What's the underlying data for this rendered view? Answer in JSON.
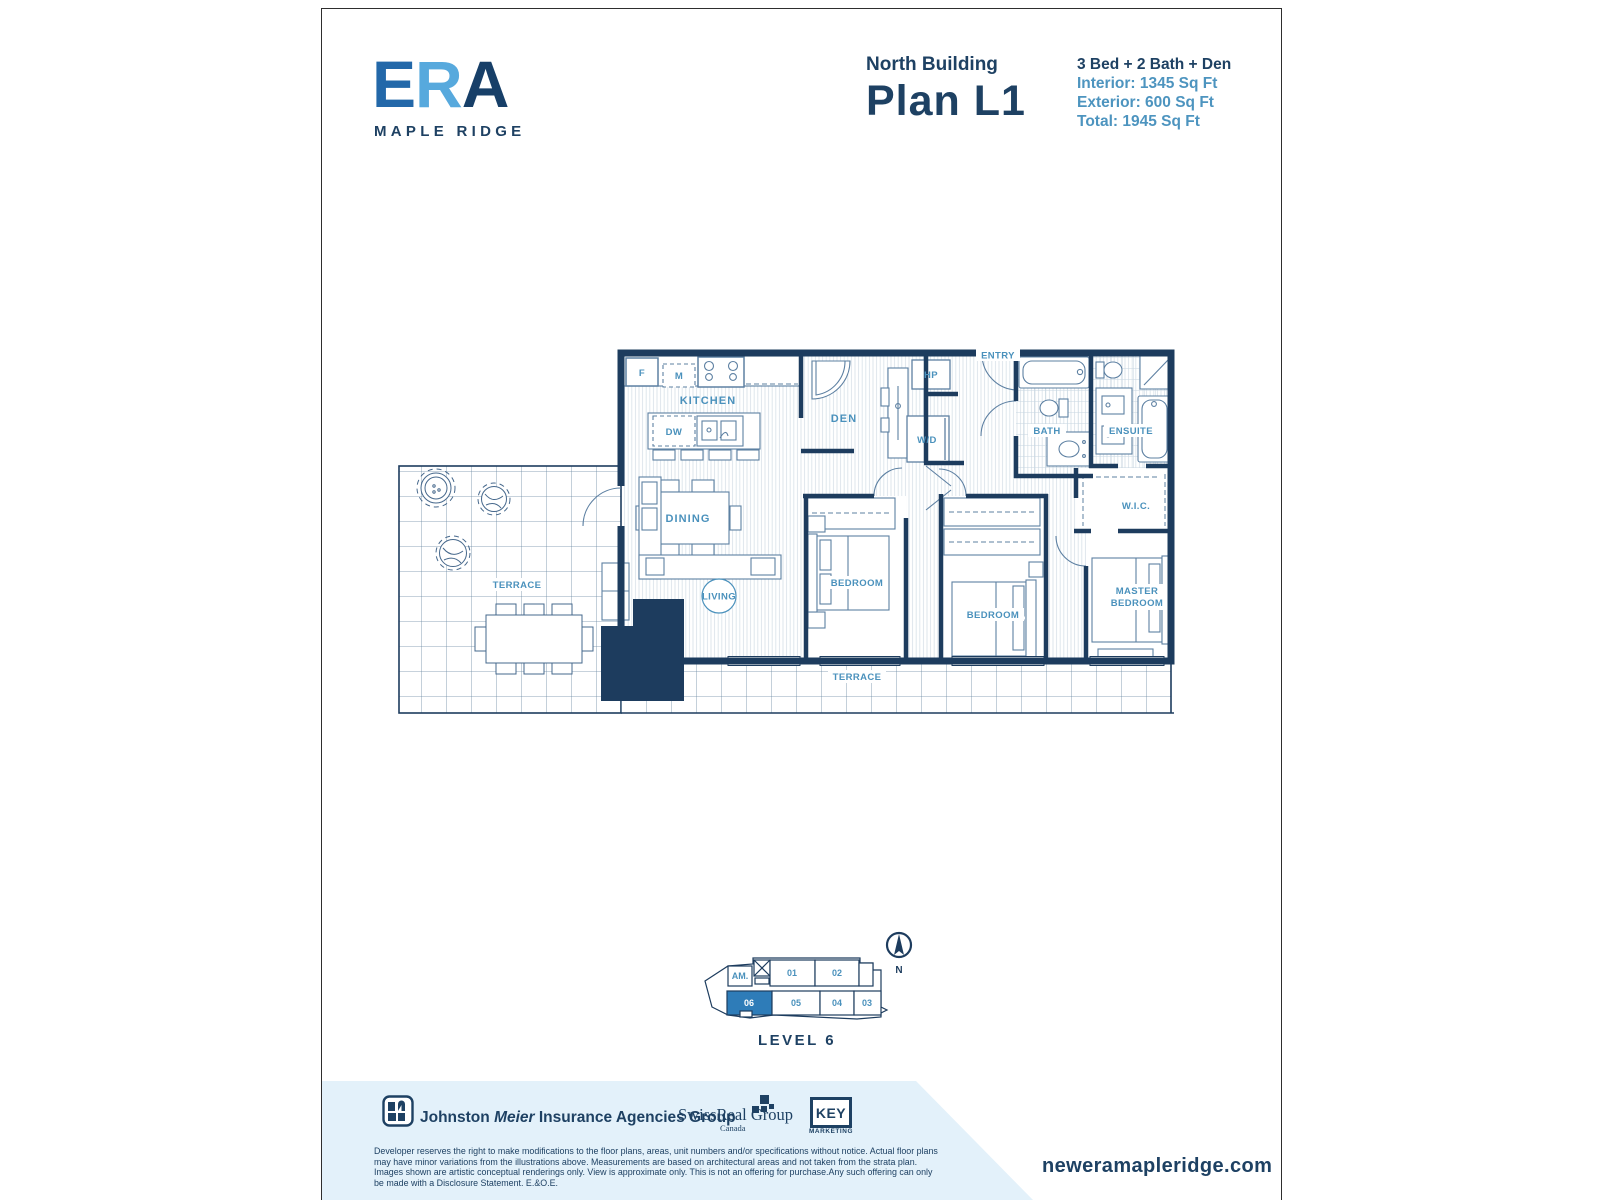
{
  "brand": {
    "logo_e": "E",
    "logo_r": "R",
    "logo_a": "A",
    "logo_sub": "MAPLE RIDGE"
  },
  "header": {
    "building": "North Building",
    "plan_name": "Plan L1",
    "spec_summary": "3 Bed + 2 Bath + Den",
    "specs": [
      "Interior: 1345 Sq Ft",
      "Exterior: 600 Sq Ft",
      "Total: 1945 Sq Ft"
    ]
  },
  "floorplan": {
    "rooms": {
      "kitchen": "KITCHEN",
      "den": "DEN",
      "dining": "DINING",
      "living": "LIVING",
      "entry": "ENTRY",
      "bath": "BATH",
      "ensuite": "ENSUITE",
      "wic": "W.I.C.",
      "bedroom1": "BEDROOM",
      "bedroom2": "BEDROOM",
      "master_line1": "MASTER",
      "master_line2": "BEDROOM",
      "terrace_left": "TERRACE",
      "terrace_bottom": "TERRACE"
    },
    "appliances": {
      "fridge": "F",
      "microwave": "M",
      "dishwasher": "DW",
      "heat_pump": "HP",
      "washer_dryer": "W/D"
    }
  },
  "keyplan": {
    "level_label": "LEVEL 6",
    "compass": "N",
    "units": {
      "am": "AM.",
      "u01": "01",
      "u02": "02",
      "u03": "03",
      "u04": "04",
      "u05": "05",
      "u06": "06"
    },
    "highlighted_unit": "06",
    "highlight_color": "#2e7cb8"
  },
  "footer": {
    "jm_part1": "Johnston ",
    "jm_part2": "Meier",
    "jm_part3": " Insurance Agencies Group",
    "swissreal": "SwissReal Group",
    "swissreal_sub": "Canada",
    "key_line1": "KEY",
    "key_line2": "MARKETING",
    "disclaimer": "Developer reserves the right to make modifications to the floor plans, areas, unit numbers and/or specifications without notice. Actual floor plans may have minor variations from the illustrations above. Measurements are based on architectural areas and not taken from the strata plan. Images shown are artistic conceptual renderings only. View is approximate only. This is not an offering for purchase.Any such offering can only be made with a Disclosure Statement. E.&O.E.",
    "website": "neweramapleridge.com"
  },
  "colors": {
    "wall_navy": "#1d3c5e",
    "label_blue": "#4a91bc",
    "text_navy": "#1e4163",
    "band_blue": "#e3f1fa",
    "highlight_blue": "#2e7cb8"
  }
}
